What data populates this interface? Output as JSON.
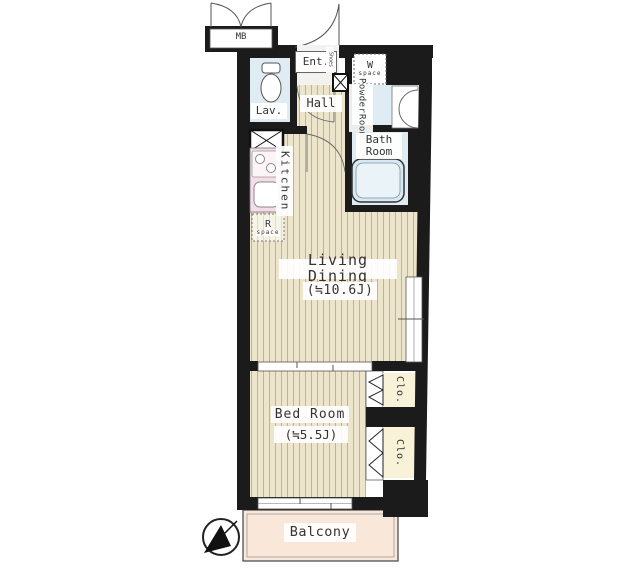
{
  "floor_plan": {
    "labels": {
      "mb": "MB",
      "entrance": "Ent.",
      "shoes": "Shoes",
      "w_space": {
        "letter": "W",
        "word": "space"
      },
      "lavatory": "Lav.",
      "hall": "Hall",
      "powder_room": {
        "line1": "Powder",
        "line2": "Room"
      },
      "bath_room": {
        "line1": "Bath",
        "line2": "Room"
      },
      "kitchen": "Kitchen",
      "r_space": {
        "letter": "R",
        "word": "space"
      },
      "living_dining": {
        "name": "Living Dining",
        "area": "(≒10.6J)"
      },
      "bed_room": {
        "name": "Bed Room",
        "area": "(≒5.5J)"
      },
      "closet_upper": "Clo.",
      "closet_lower": "Clo.",
      "balcony": "Balcony"
    },
    "icons": {
      "compass": "north-arrow-icon",
      "toilet": "toilet-icon",
      "washbasin": "washbasin-icon",
      "bathtub": "bathtub-icon",
      "stove": "stove-icon",
      "kitchen_sink": "kitchen-sink-icon",
      "entrance_door": "door-swing-icon",
      "mb_doors": "double-door-swing-icon",
      "shoe_cabinet": "crossed-box-icon",
      "shaft": "crossed-box-icon"
    },
    "colors": {
      "wall": "#1b1b1b",
      "wood_floor": "#ece5cb",
      "wood_stripe": "#bdb493",
      "wet_area": "#dfecf3",
      "kitchen_counter": "#f5dce8",
      "closet": "#f8f2d8",
      "balcony": "#f9e7d9",
      "tub": "#d9e9f3"
    }
  }
}
